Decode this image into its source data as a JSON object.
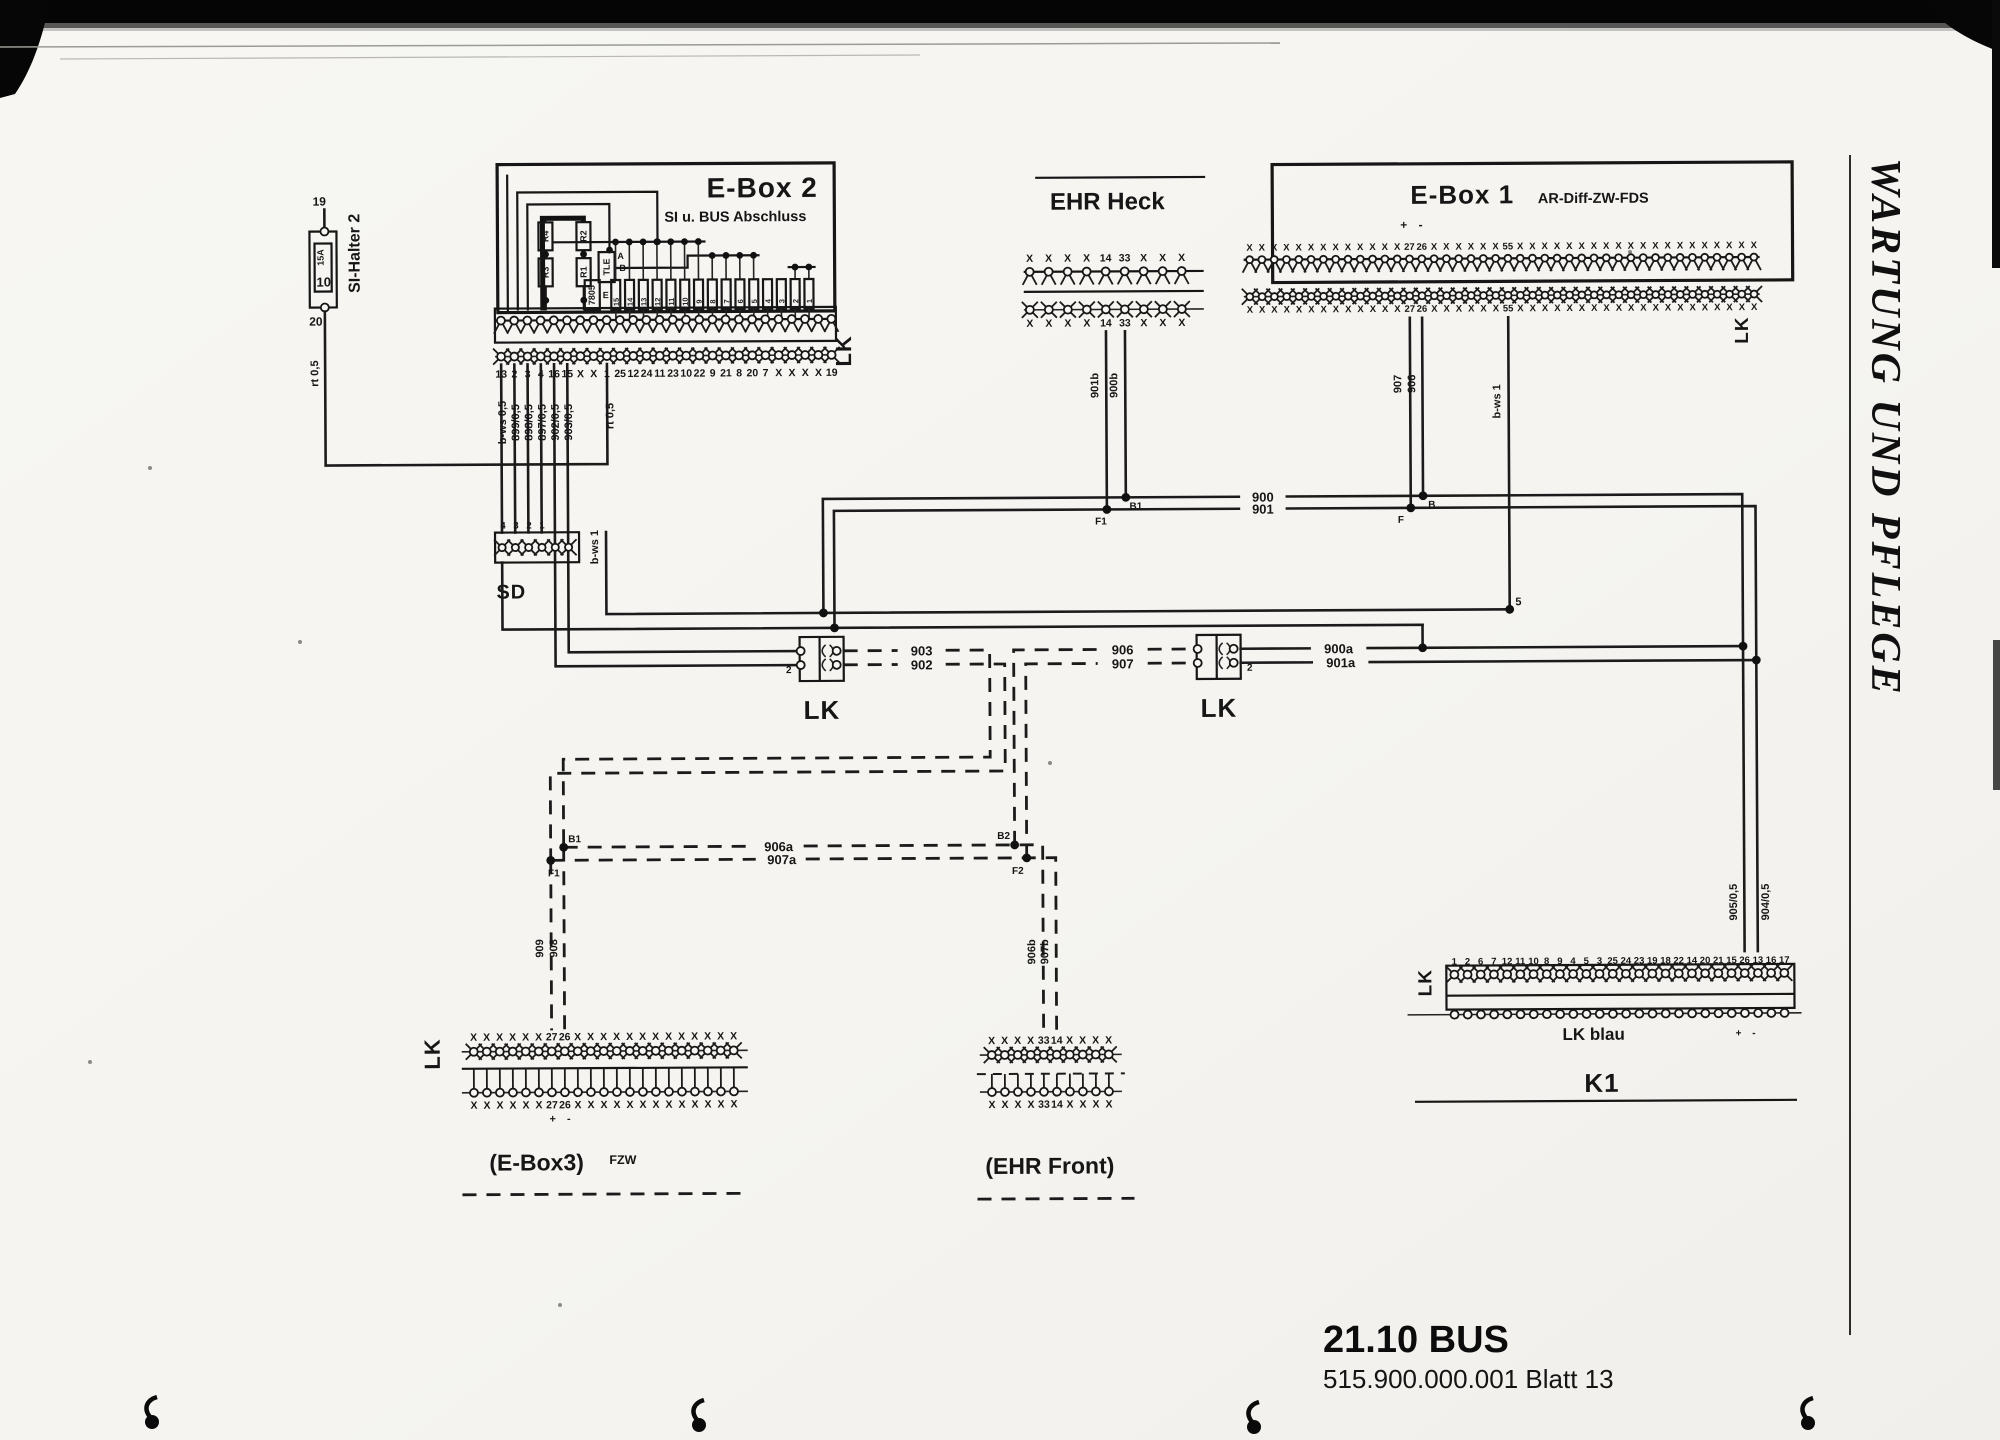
{
  "page": {
    "side_title": "WARTUNG UND PFLEGE",
    "footer_title": "21.10 BUS",
    "footer_subtitle": "515.900.000.001 Blatt 13"
  },
  "si_halter": {
    "label": "SI-Halter 2",
    "pin_top": "19",
    "pin_bottom": "20",
    "fuse_rating": "15A",
    "fuse_value": "10",
    "wire": "rt 0,5"
  },
  "ebox2": {
    "title": "E-Box 2",
    "subtitle": "SI u. BUS Abschluss",
    "connector_label": "LK",
    "components": {
      "r4": "R4",
      "r2": "R2",
      "r3": "R3",
      "r1": "R1",
      "tle": "TLE",
      "tle_pin_a": "A",
      "tle_pin_b": "B",
      "tle_pin_e": "E",
      "regulator": "7805"
    },
    "fuse_numbers": [
      "15",
      "14",
      "13",
      "12",
      "11",
      "10",
      "9",
      "8",
      "7",
      "6",
      "5",
      "4",
      "3",
      "2",
      "1"
    ],
    "pins": [
      "13",
      "2",
      "3",
      "4",
      "16",
      "15",
      "X",
      "X",
      "1",
      "25",
      "12",
      "24",
      "11",
      "23",
      "10",
      "22",
      "9",
      "21",
      "8",
      "20",
      "7",
      "X",
      "X",
      "X",
      "X",
      "19"
    ],
    "wire_labels": [
      "b-ws 0,5",
      "899/0,5",
      "898/0,5",
      "897/0,5",
      "902/0,5",
      "903/0,5"
    ],
    "wire_pin1": "rt 0,5"
  },
  "sd": {
    "label": "SD",
    "pin_labels": [
      "4",
      "3",
      "2",
      "1"
    ],
    "wire_bws1": "b-ws 1"
  },
  "ehr_heck": {
    "title": "EHR Heck",
    "pins_top": [
      "X",
      "X",
      "X",
      "X",
      "14",
      "33",
      "X",
      "X",
      "X"
    ],
    "pins_bottom": [
      "X",
      "X",
      "X",
      "X",
      "14",
      "33",
      "X",
      "X",
      "X"
    ],
    "wire_left": "901b",
    "wire_right": "900b",
    "junction_left": "F1",
    "junction_right": "B1"
  },
  "ebox1": {
    "title": "E-Box 1",
    "subtitle": "AR-Diff-ZW-FDS",
    "polarity": "+ -",
    "connector_label": "LK",
    "pins_top": [
      "X",
      "X",
      "X",
      "X",
      "X",
      "X",
      "X",
      "X",
      "X",
      "X",
      "X",
      "X",
      "X",
      "27",
      "26",
      "X",
      "X",
      "X",
      "X",
      "X",
      "X",
      "55",
      "X",
      "X",
      "X",
      "X",
      "X",
      "X",
      "X",
      "X",
      "X",
      "X",
      "X",
      "X",
      "X",
      "X",
      "X",
      "X",
      "X",
      "X",
      "X",
      "X"
    ],
    "pins_bottom": [
      "X",
      "X",
      "X",
      "X",
      "X",
      "X",
      "X",
      "X",
      "X",
      "X",
      "X",
      "X",
      "X",
      "27",
      "26",
      "X",
      "X",
      "X",
      "X",
      "X",
      "X",
      "55",
      "X",
      "X",
      "X",
      "X",
      "X",
      "X",
      "X",
      "X",
      "X",
      "X",
      "X",
      "X",
      "X",
      "X",
      "X",
      "X",
      "X",
      "X",
      "X",
      "X"
    ],
    "wire_27": "907",
    "wire_26": "906",
    "wire_55": "b-ws 1",
    "junction_b": "B",
    "junction_f": "F",
    "junction_5": "5"
  },
  "couplers": {
    "left": {
      "label": "LK",
      "pin": "2"
    },
    "right": {
      "label": "LK",
      "pin": "2"
    }
  },
  "wires": {
    "w900": "900",
    "w901": "901",
    "w900a": "900a",
    "w901a": "901a",
    "w902": "902",
    "w903": "903",
    "w906": "906",
    "w907": "907",
    "w906a": "906a",
    "w907a": "907a",
    "w906b": "906b",
    "w907b": "907b",
    "w908": "908",
    "w909": "909",
    "w905": "905/0,5",
    "w904": "904/0,5",
    "junction_b1": "B1",
    "junction_f1": "F1",
    "junction_b2": "B2",
    "junction_f2": "F2"
  },
  "ebox3": {
    "title": "(E-Box3)",
    "suffix": "FZW",
    "connector_label": "LK",
    "polarity": "+ -",
    "pins_top": [
      "X",
      "X",
      "X",
      "X",
      "X",
      "X",
      "27",
      "26",
      "X",
      "X",
      "X",
      "X",
      "X",
      "X",
      "X",
      "X",
      "X",
      "X",
      "X",
      "X",
      "X"
    ],
    "pins_bottom": [
      "X",
      "X",
      "X",
      "X",
      "X",
      "X",
      "27",
      "26",
      "X",
      "X",
      "X",
      "X",
      "X",
      "X",
      "X",
      "X",
      "X",
      "X",
      "X",
      "X",
      "X"
    ]
  },
  "ehr_front": {
    "title": "(EHR Front)",
    "pins_top": [
      "X",
      "X",
      "X",
      "X",
      "33",
      "14",
      "X",
      "X",
      "X",
      "X"
    ],
    "pins_bottom": [
      "X",
      "X",
      "X",
      "X",
      "33",
      "14",
      "X",
      "X",
      "X",
      "X"
    ]
  },
  "k1": {
    "title": "K1",
    "connector_label": "LK",
    "row_label": "LK blau",
    "polarity": "+ -",
    "pins": [
      "1",
      "2",
      "6",
      "7",
      "12",
      "11",
      "10",
      "8",
      "9",
      "4",
      "5",
      "3",
      "25",
      "24",
      "23",
      "19",
      "18",
      "22",
      "14",
      "20",
      "21",
      "15",
      "26",
      "13",
      "16",
      "17"
    ]
  }
}
